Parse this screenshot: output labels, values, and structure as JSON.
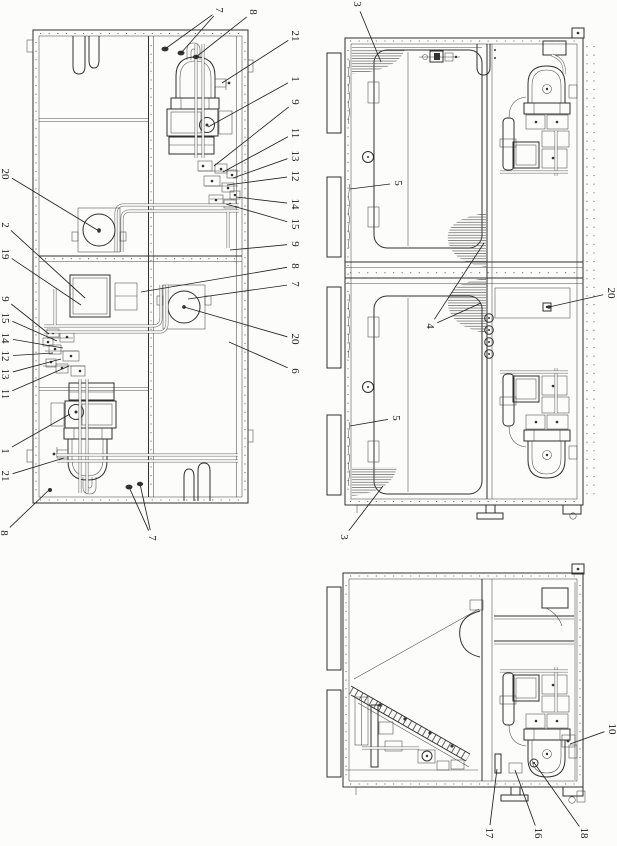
{
  "page": {
    "background": "#fcfcfb",
    "ink": "#2f2f2f",
    "label_font_size": 11
  },
  "figures": [
    {
      "id": "top-view",
      "name": "packaged-unit-top-view",
      "callouts": [
        {
          "label": "7",
          "x": 219,
          "y": 10,
          "targets": [
            [
              165,
              49
            ],
            [
              181,
              53
            ]
          ]
        },
        {
          "label": "8",
          "x": 253,
          "y": 12,
          "targets": [
            [
              196,
              57
            ]
          ]
        },
        {
          "label": "21",
          "x": 295,
          "y": 36,
          "targets": [
            [
              222,
              83
            ]
          ]
        },
        {
          "label": "1",
          "x": 295,
          "y": 79,
          "targets": [
            [
              208,
              127
            ]
          ]
        },
        {
          "label": "9",
          "x": 295,
          "y": 102,
          "targets": [
            [
              214,
              166
            ]
          ]
        },
        {
          "label": "11",
          "x": 295,
          "y": 133,
          "targets": [
            [
              223,
              172
            ]
          ]
        },
        {
          "label": "13",
          "x": 295,
          "y": 156,
          "targets": [
            [
              233,
              178
            ]
          ]
        },
        {
          "label": "12",
          "x": 295,
          "y": 176,
          "targets": [
            [
              227,
              185
            ]
          ]
        },
        {
          "label": "14",
          "x": 295,
          "y": 204,
          "targets": [
            [
              236,
              197
            ]
          ]
        },
        {
          "label": "15",
          "x": 295,
          "y": 224,
          "targets": [
            [
              226,
              204
            ]
          ]
        },
        {
          "label": "9",
          "x": 295,
          "y": 244,
          "targets": [
            [
              230,
              250
            ]
          ]
        },
        {
          "label": "8",
          "x": 295,
          "y": 266,
          "targets": [
            [
              141,
              292
            ]
          ]
        },
        {
          "label": "7",
          "x": 295,
          "y": 284,
          "targets": [
            [
              188,
              299
            ]
          ]
        },
        {
          "label": "20",
          "x": 295,
          "y": 339,
          "targets": [
            [
              184,
              307
            ]
          ],
          "dot": true
        },
        {
          "label": "6",
          "x": 295,
          "y": 371,
          "targets": [
            [
              229,
              342
            ]
          ]
        },
        {
          "label": "20",
          "x": 5,
          "y": 174,
          "targets": [
            [
              99,
              231
            ]
          ],
          "dot": true
        },
        {
          "label": "2",
          "x": 5,
          "y": 225,
          "targets": [
            [
              85,
              298
            ]
          ]
        },
        {
          "label": "19",
          "x": 5,
          "y": 254,
          "targets": [
            [
              81,
              305
            ]
          ]
        },
        {
          "label": "9",
          "x": 5,
          "y": 299,
          "targets": [
            [
              49,
              334
            ]
          ]
        },
        {
          "label": "15",
          "x": 5,
          "y": 318,
          "targets": [
            [
              57,
              341
            ]
          ]
        },
        {
          "label": "14",
          "x": 5,
          "y": 338,
          "targets": [
            [
              63,
              348
            ]
          ]
        },
        {
          "label": "12",
          "x": 5,
          "y": 356,
          "targets": [
            [
              53,
              353
            ]
          ]
        },
        {
          "label": "13",
          "x": 5,
          "y": 374,
          "targets": [
            [
              61,
              359
            ]
          ]
        },
        {
          "label": "11",
          "x": 5,
          "y": 394,
          "targets": [
            [
              69,
              366
            ]
          ]
        },
        {
          "label": "1",
          "x": 5,
          "y": 451,
          "targets": [
            [
              70,
              414
            ]
          ]
        },
        {
          "label": "21",
          "x": 5,
          "y": 476,
          "targets": [
            [
              64,
              458
            ]
          ]
        },
        {
          "label": "8",
          "x": 4,
          "y": 533,
          "targets": [
            [
              50,
              489
            ]
          ]
        },
        {
          "label": "7",
          "x": 152,
          "y": 538,
          "targets": [
            [
              129,
              487
            ],
            [
              140,
              484
            ]
          ]
        }
      ]
    },
    {
      "id": "side-view",
      "name": "packaged-unit-side-view",
      "callouts": [
        {
          "label": "3",
          "x": 357,
          "y": 4,
          "targets": [
            [
              381,
              62
            ]
          ]
        },
        {
          "label": "5",
          "x": 398,
          "y": 183,
          "targets": [
            [
              350,
              189
            ]
          ]
        },
        {
          "label": "4",
          "x": 430,
          "y": 326,
          "targets": [
            [
              484,
              243
            ],
            [
              481,
              303
            ]
          ]
        },
        {
          "label": "20",
          "x": 611,
          "y": 293,
          "targets": [
            [
              549,
              307
            ]
          ],
          "dot": true
        },
        {
          "label": "5",
          "x": 396,
          "y": 418,
          "targets": [
            [
              350,
              426
            ]
          ]
        },
        {
          "label": "3",
          "x": 344,
          "y": 537,
          "targets": [
            [
              383,
              486
            ]
          ]
        }
      ]
    },
    {
      "id": "end-view",
      "name": "packaged-unit-end-view",
      "callouts": [
        {
          "label": "10",
          "x": 612,
          "y": 729,
          "targets": [
            [
              570,
              744
            ]
          ]
        },
        {
          "label": "17",
          "x": 489,
          "y": 833,
          "targets": [
            [
              497,
              769
            ]
          ]
        },
        {
          "label": "16",
          "x": 538,
          "y": 833,
          "targets": [
            [
              515,
              770
            ]
          ]
        },
        {
          "label": "18",
          "x": 584,
          "y": 833,
          "targets": [
            [
              535,
              764
            ]
          ]
        }
      ]
    }
  ]
}
